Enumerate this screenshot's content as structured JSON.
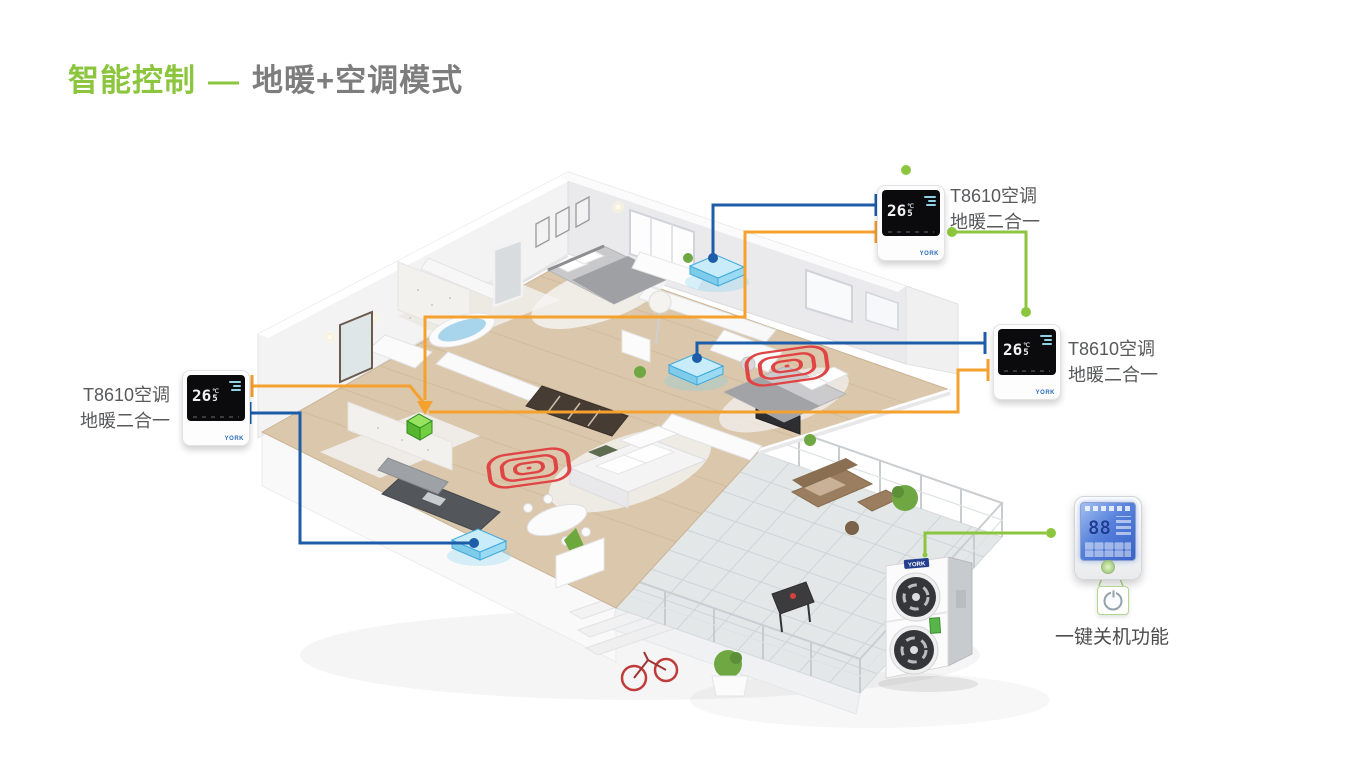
{
  "title": {
    "highlight": "智能控制",
    "dash": "—",
    "rest": "地暖+空调模式"
  },
  "colors": {
    "accent-green": "#8CC63E",
    "line-blue": "#1D5CA8",
    "line-orange": "#F5A12D",
    "coil-red": "#E04545",
    "title-gray": "#7D7D7D",
    "label-gray": "#58595B"
  },
  "thermostats": [
    {
      "id": "top",
      "label_line1": "T8610空调",
      "label_line2": "地暖二合一",
      "temp": "26",
      "temp_decimal": "5",
      "unit": "℃",
      "brand": "YORK"
    },
    {
      "id": "right",
      "label_line1": "T8610空调",
      "label_line2": "地暖二合一",
      "temp": "26",
      "temp_decimal": "5",
      "unit": "℃",
      "brand": "YORK"
    },
    {
      "id": "left",
      "label_line1": "T8610空调",
      "label_line2": "地暖二合一",
      "temp": "26",
      "temp_decimal": "5",
      "unit": "℃",
      "brand": "YORK"
    }
  ],
  "wall_controller": {
    "display_digits": "88",
    "shutdown_label": "一键关机功能"
  },
  "outdoor_unit": {
    "brand": "YORK"
  },
  "icons": {
    "connector_dot": "green-node-dot",
    "flow_arrow": "down-arrow",
    "power": "power-icon",
    "fan_coil": "fan-coil-slab",
    "floor_heating": "heating-coil-spiral",
    "hub": "gateway-cube"
  }
}
